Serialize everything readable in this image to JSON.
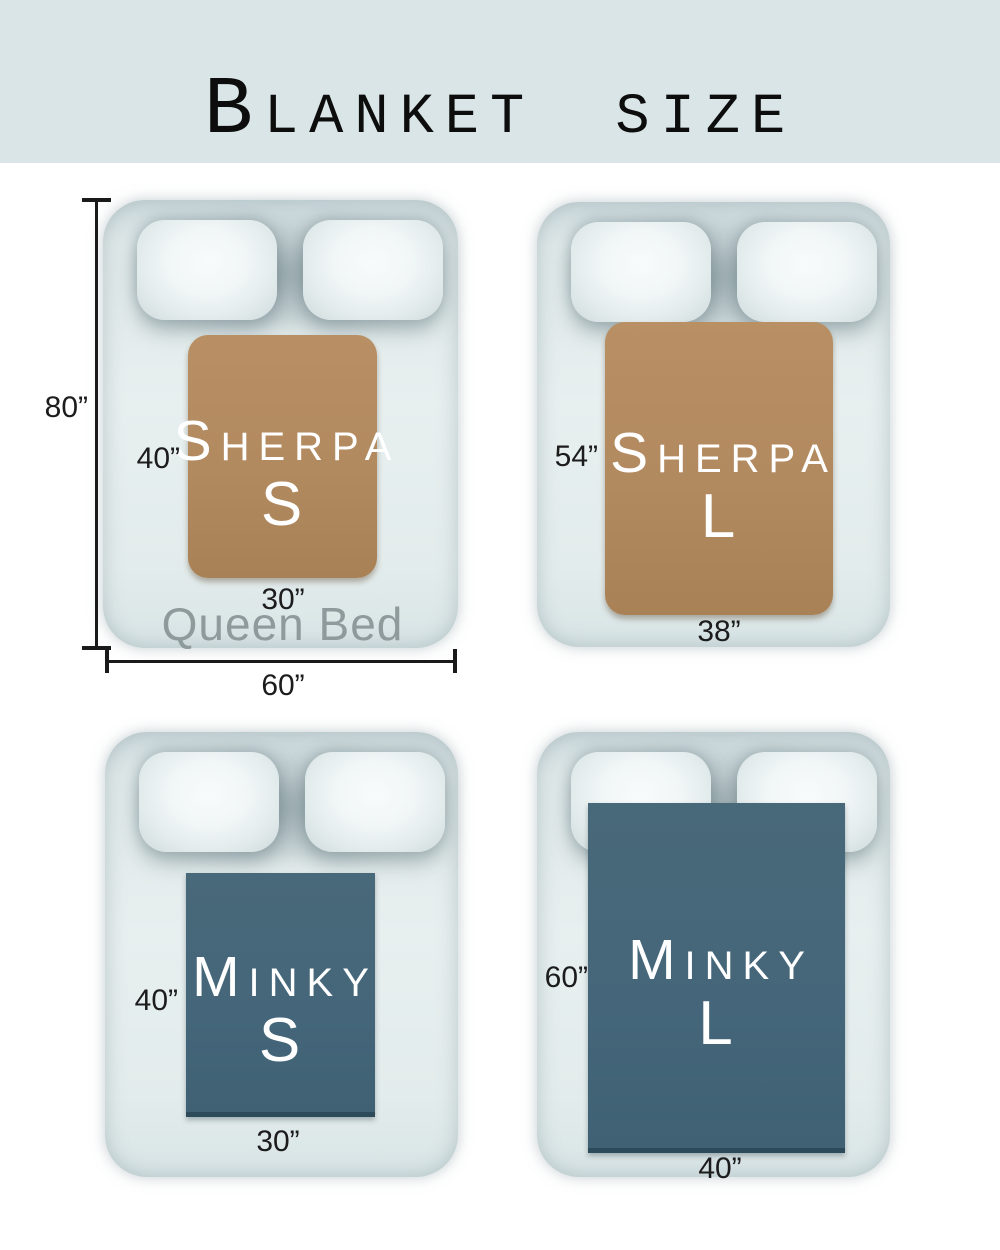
{
  "title": "Blanket size",
  "colors": {
    "page-bg": "#ffffff",
    "header-bg": "#d9e5e7",
    "title-text": "#0d0d0d",
    "sherpa": "#b28a60",
    "minky": "#45667a",
    "minky-edge": "#2d4a5a",
    "blanket-text": "#ffffff",
    "dim-text": "#1c1c1c",
    "bed-label": "#8e9a9b"
  },
  "beds": [
    {
      "bed_name": "Queen Bed",
      "bed_height_label": "80”",
      "bed_width_label": "60”",
      "blanket": {
        "name": "Sherpa",
        "size": "S",
        "height_label": "40”",
        "width_label": "30”"
      }
    },
    {
      "blanket": {
        "name": "Sherpa",
        "size": "L",
        "height_label": "54”",
        "width_label": "38”"
      }
    },
    {
      "blanket": {
        "name": "Minky",
        "size": "S",
        "height_label": "40”",
        "width_label": "30”"
      }
    },
    {
      "blanket": {
        "name": "Minky",
        "size": "L",
        "height_label": "60”",
        "width_label": "40”"
      }
    }
  ]
}
